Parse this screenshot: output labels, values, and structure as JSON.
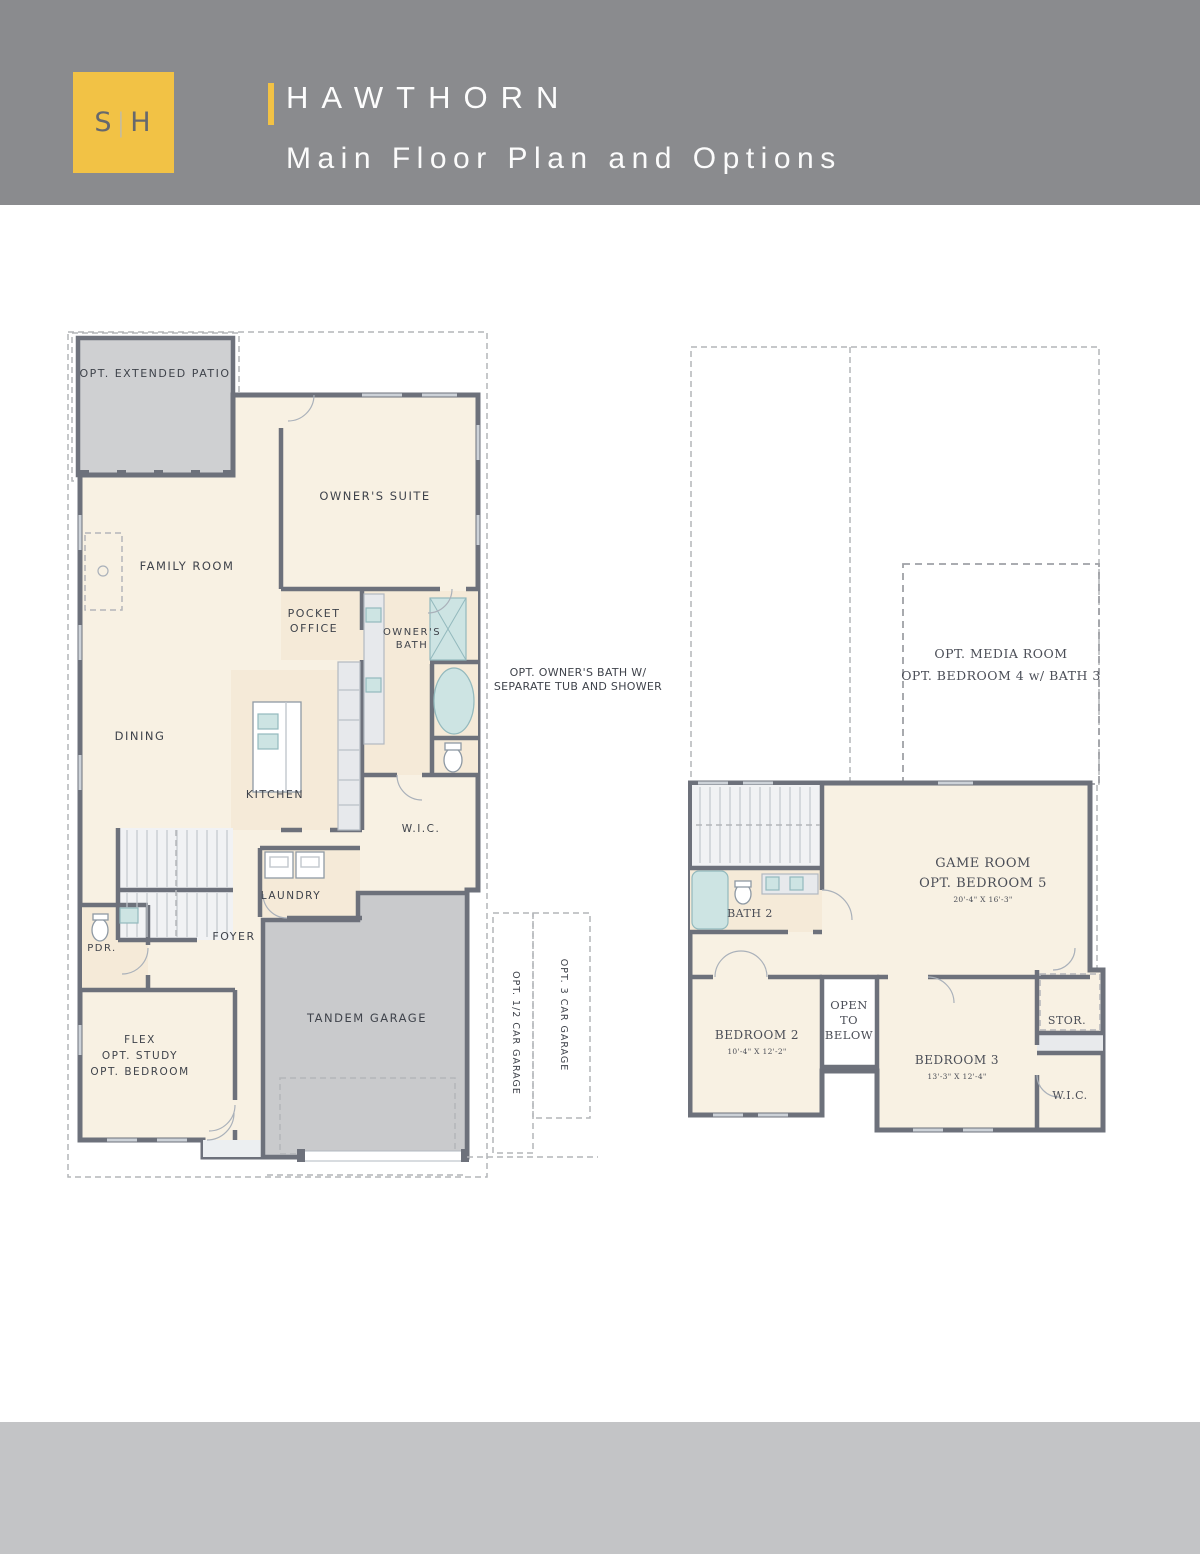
{
  "header": {
    "logo_s": "S",
    "logo_divider": "|",
    "logo_h": "H",
    "title": "HAWTHORN",
    "subtitle": "Main Floor Plan and Options"
  },
  "colors": {
    "accent": "#F2C245",
    "header_band": "#8A8B8E",
    "footer_band": "#C3C4C6",
    "wall": "#6D717B",
    "floor_cream": "#F8F1E3",
    "option_gray": "#CFD0D2"
  },
  "note_between_plans": {
    "line1": "OPT. OWNER'S BATH W/",
    "line2": "SEPARATE TUB AND SHOWER"
  },
  "main_floor": {
    "patio": "OPT. EXTENDED PATIO",
    "owners_suite": "OWNER'S SUITE",
    "family_room": "FAMILY ROOM",
    "pocket_office_1": "POCKET",
    "pocket_office_2": "OFFICE",
    "owners_bath_1": "OWNER'S",
    "owners_bath_2": "BATH",
    "dining": "DINING",
    "kitchen": "KITCHEN",
    "wic": "W.I.C.",
    "laundry": "LAUNDRY",
    "pdr": "PDR.",
    "foyer": "FOYER",
    "flex_1": "FLEX",
    "flex_2": "OPT. STUDY",
    "flex_3": "OPT. BEDROOM",
    "tandem_garage": "TANDEM GARAGE",
    "opt_half_garage": "OPT. 1/2 CAR GARAGE",
    "opt_3car_garage": "OPT. 3 CAR GARAGE"
  },
  "second_floor": {
    "opt_media_1": "OPT. MEDIA ROOM",
    "opt_media_2": "OPT. BEDROOM 4 w/ BATH 3",
    "game_room_1": "GAME ROOM",
    "game_room_2": "OPT. BEDROOM 5",
    "game_room_dims": "20'-4\" X 16'-3\"",
    "bath2": "BATH 2",
    "bedroom2": "BEDROOM 2",
    "bedroom2_dims": "10'-4\" X 12'-2\"",
    "open_1": "OPEN",
    "open_2": "TO",
    "open_3": "BELOW",
    "bedroom3": "BEDROOM 3",
    "bedroom3_dims": "13'-3\" X 12'-4\"",
    "stor": "STOR.",
    "wic": "W.I.C."
  }
}
